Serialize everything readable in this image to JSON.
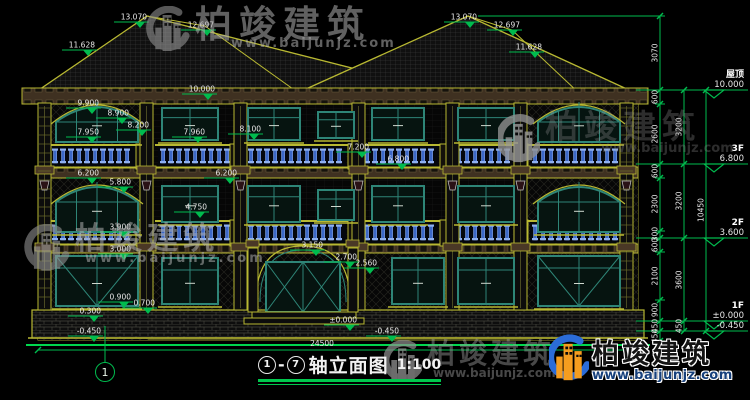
{
  "brand": {
    "name": "柏竣建筑",
    "url": "www.baijunjz.com"
  },
  "drawing": {
    "title": {
      "axis_start": "1",
      "separator": "-",
      "axis_end": "7",
      "text": "轴立面图",
      "scale": "1:100"
    },
    "axis_bubble_label": "1",
    "bottom_dim": {
      "label": "24500"
    },
    "levels": [
      {
        "name": "屋顶",
        "value": "10.000",
        "y": 90
      },
      {
        "name": "3F",
        "value": "6.800",
        "y": 164
      },
      {
        "name": "2F",
        "value": "3.600",
        "y": 238
      },
      {
        "name": "1F",
        "value": "±0.000",
        "y": 321
      },
      {
        "name": "",
        "value": "-0.450",
        "y": 331
      }
    ],
    "elevation_markers": [
      {
        "label": "13.070",
        "x": 140,
        "y": 22
      },
      {
        "label": "12.697",
        "x": 207,
        "y": 30
      },
      {
        "label": "11.628",
        "x": 88,
        "y": 50
      },
      {
        "label": "13.070",
        "x": 470,
        "y": 22
      },
      {
        "label": "12.697",
        "x": 513,
        "y": 30
      },
      {
        "label": "11.628",
        "x": 535,
        "y": 52
      },
      {
        "label": "10.000",
        "x": 208,
        "y": 94
      },
      {
        "label": "9.900",
        "x": 92,
        "y": 108
      },
      {
        "label": "8.900",
        "x": 122,
        "y": 118
      },
      {
        "label": "8.200",
        "x": 142,
        "y": 130
      },
      {
        "label": "7.950",
        "x": 92,
        "y": 137
      },
      {
        "label": "7.960",
        "x": 198,
        "y": 137
      },
      {
        "label": "8.100",
        "x": 254,
        "y": 134
      },
      {
        "label": "7.200",
        "x": 362,
        "y": 152
      },
      {
        "label": "6.800",
        "x": 402,
        "y": 164
      },
      {
        "label": "6.200",
        "x": 92,
        "y": 178
      },
      {
        "label": "5.800",
        "x": 124,
        "y": 187
      },
      {
        "label": "6.200",
        "x": 230,
        "y": 178
      },
      {
        "label": "4.750",
        "x": 200,
        "y": 212
      },
      {
        "label": "3.900",
        "x": 124,
        "y": 232
      },
      {
        "label": "3.150",
        "x": 316,
        "y": 250
      },
      {
        "label": "3.000",
        "x": 124,
        "y": 254
      },
      {
        "label": "2.700",
        "x": 350,
        "y": 262
      },
      {
        "label": "2.560",
        "x": 370,
        "y": 268
      },
      {
        "label": "0.900",
        "x": 124,
        "y": 302
      },
      {
        "label": "0.700",
        "x": 148,
        "y": 308
      },
      {
        "label": "0.300",
        "x": 94,
        "y": 316
      },
      {
        "label": "±0.000",
        "x": 350,
        "y": 325
      },
      {
        "label": "-0.450",
        "x": 94,
        "y": 336
      },
      {
        "label": "-0.450",
        "x": 392,
        "y": 336
      }
    ],
    "dim_chains": [
      {
        "x": 660,
        "boundaries": [
          16,
          90,
          104,
          164,
          178,
          231,
          238,
          252,
          300,
          321,
          331,
          341
        ],
        "segments": [
          {
            "label": "3070",
            "y": 53
          },
          {
            "label": "600",
            "y": 97
          },
          {
            "label": "2600",
            "y": 134
          },
          {
            "label": "600",
            "y": 171
          },
          {
            "label": "2300",
            "y": 204
          },
          {
            "label": "300",
            "y": 234
          },
          {
            "label": "600",
            "y": 245
          },
          {
            "label": "2100",
            "y": 276
          },
          {
            "label": "900",
            "y": 310
          },
          {
            "label": "450",
            "y": 326
          },
          {
            "label": "450",
            "y": 336
          }
        ]
      },
      {
        "x": 684,
        "boundaries": [
          90,
          164,
          238,
          321,
          331
        ],
        "segments": [
          {
            "label": "3200",
            "y": 127
          },
          {
            "label": "3200",
            "y": 201
          },
          {
            "label": "3600",
            "y": 280
          },
          {
            "label": "450",
            "y": 326
          }
        ]
      },
      {
        "x": 706,
        "boundaries": [
          90,
          331
        ],
        "segments": [
          {
            "label": "10450",
            "y": 210
          }
        ]
      }
    ],
    "colors": {
      "line_yellow": "#b8b832",
      "marker_green": "#00bb4e",
      "window_teal": "#2e8577",
      "baluster_blue": "#3c68c8",
      "logo_blue": "#2b6cd8",
      "logo_orange": "#f59d1f"
    }
  }
}
